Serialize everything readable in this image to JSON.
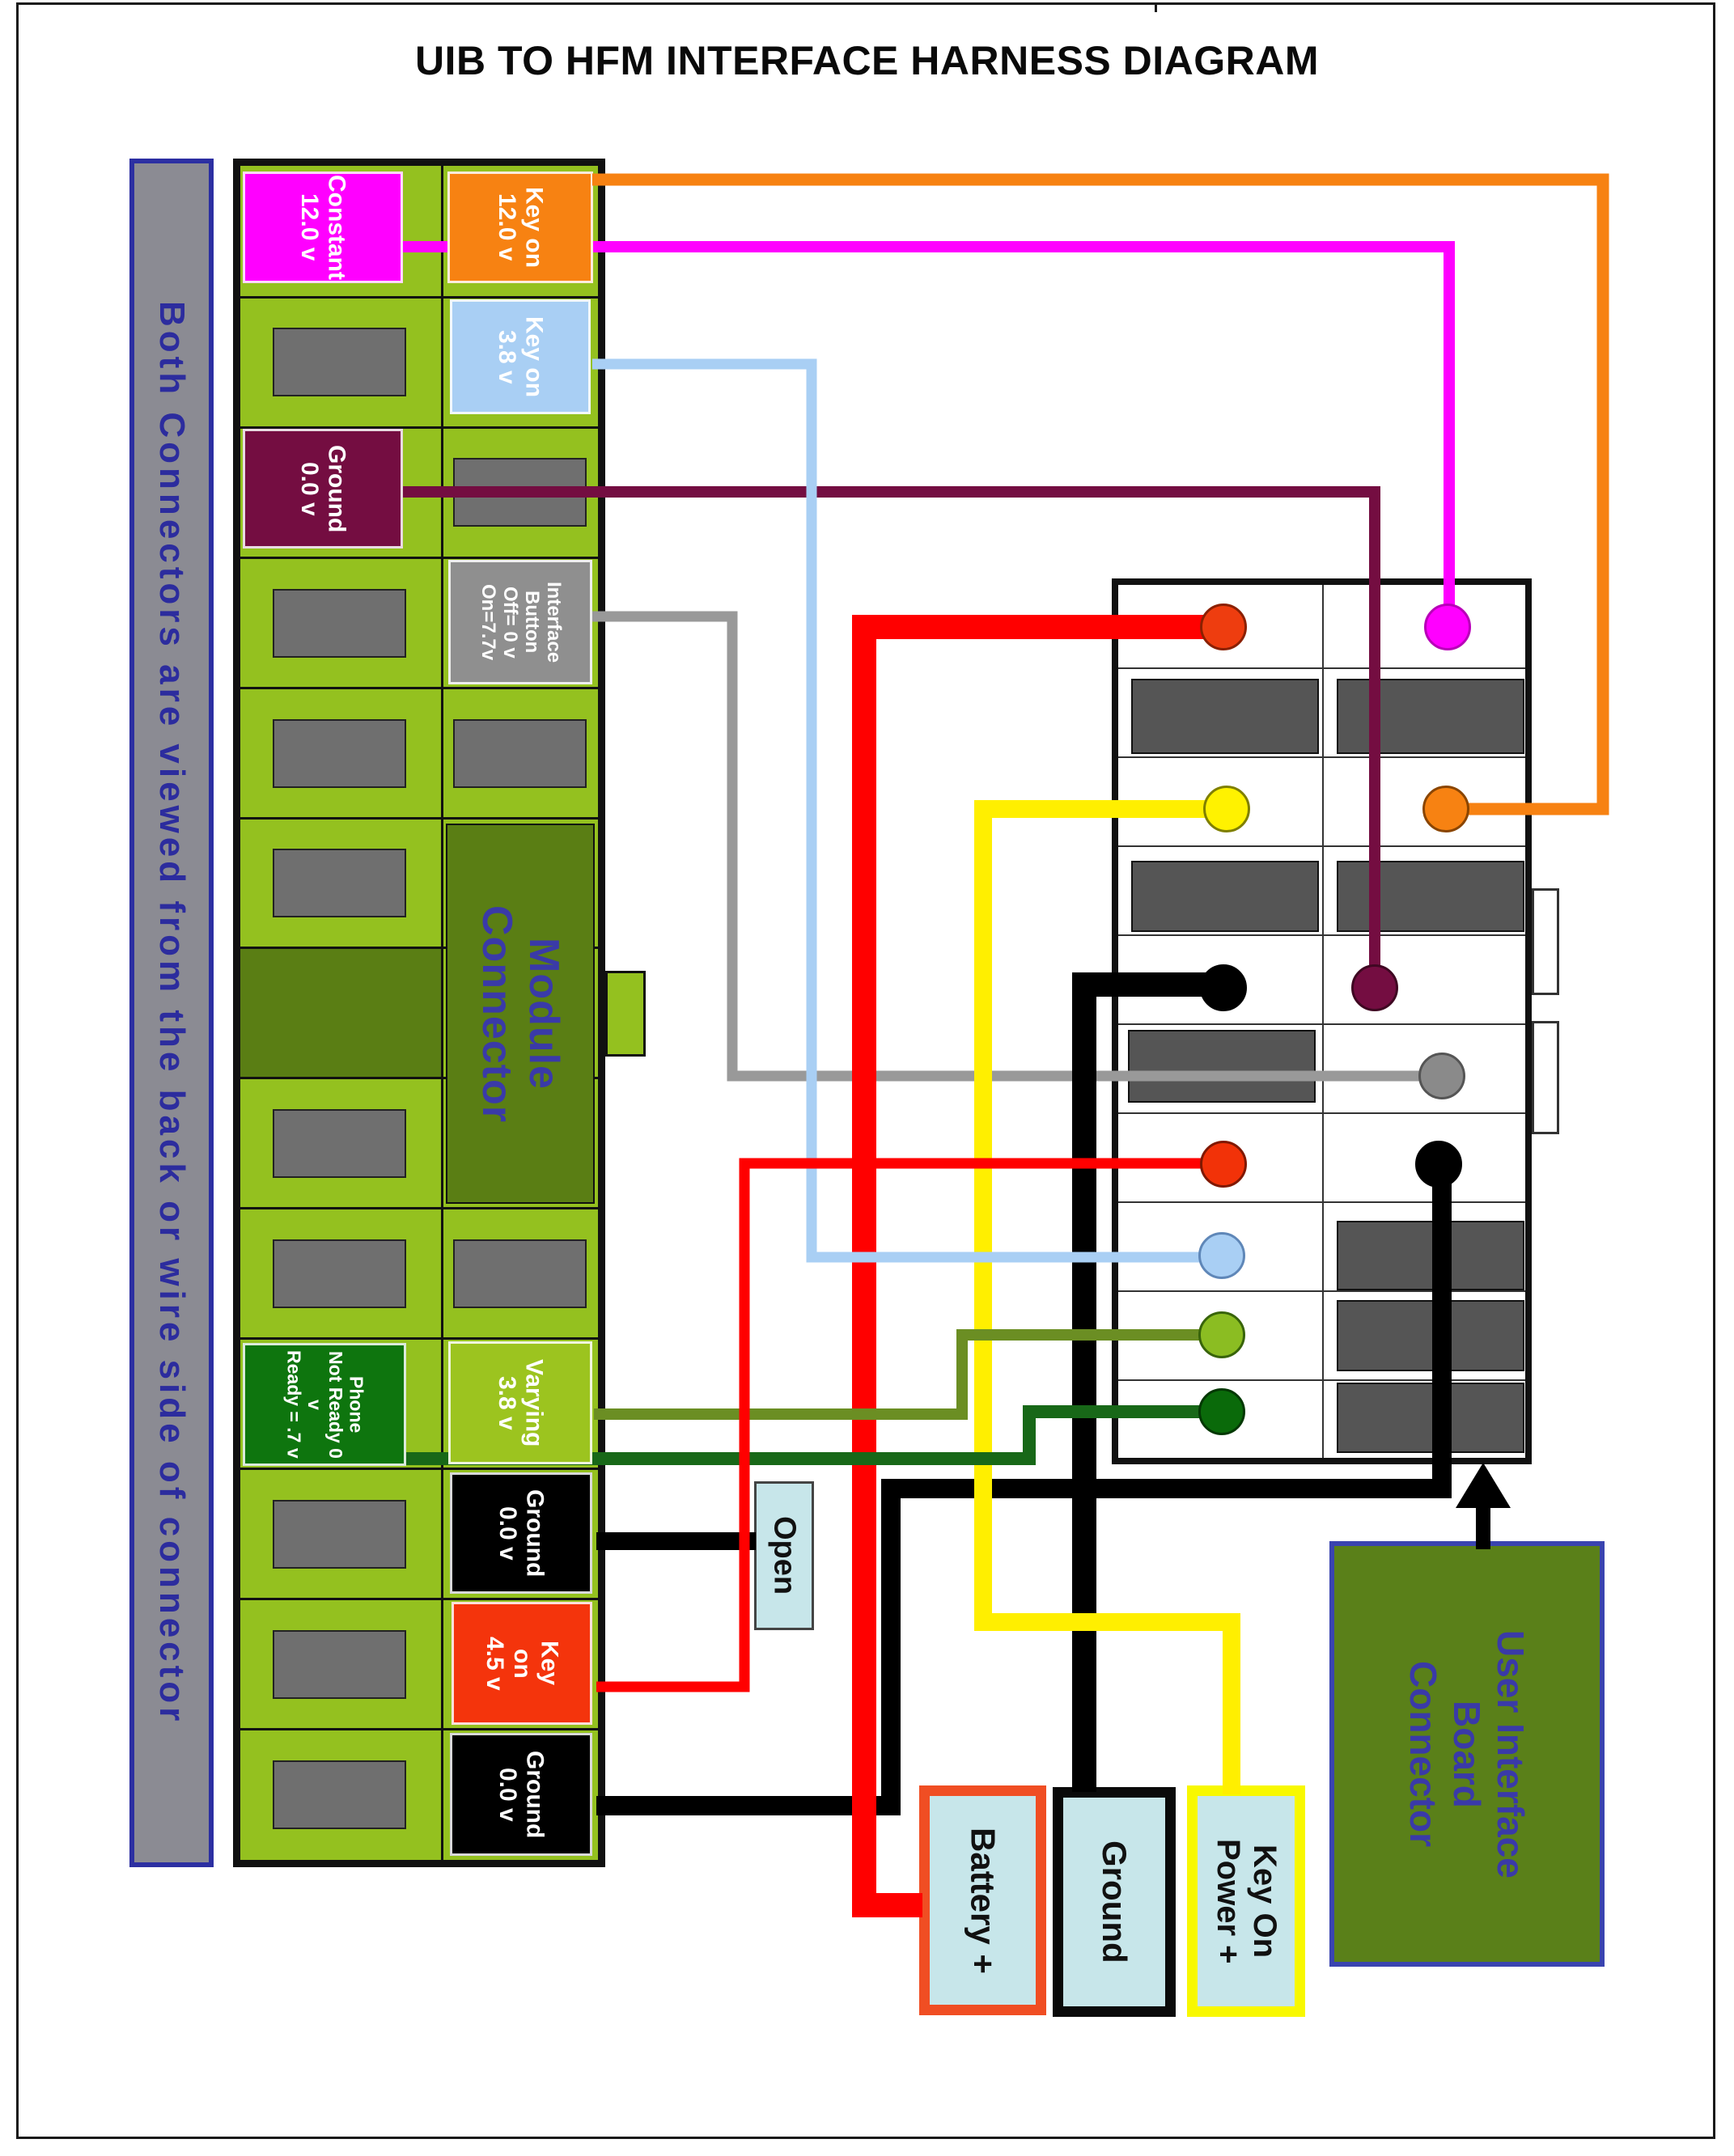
{
  "title": "UIB TO HFM INTERFACE HARNESS DIAGRAM",
  "side_note": "Both Connectors are viewed from the back or wire side of connector",
  "module_connector": {
    "name": "Module\nConnector",
    "labels": {
      "constant_12v": "Constant\n12.0 v",
      "key_on_12v": "Key on\n12.0 v",
      "key_on_3_8v": "Key on\n3.8 v",
      "ground_top": "Ground\n0.0 v",
      "interface_button": "Interface\nButton\nOff= 0 v\nOn=7.7v",
      "phone": "Phone\nNot Ready 0 v\nReady = .7 v",
      "varying_3_8v": "Varying\n3.8 v",
      "ground_mid": "Ground\n0.0 v",
      "key_on_4_5v": "Key\non\n4.5 v",
      "ground_bottom": "Ground\n0.0 v"
    }
  },
  "uib_connector": {
    "name": "User Interface\nBoard\nConnector",
    "pins": [
      {
        "row": 1,
        "left": "red-orange",
        "right": "magenta"
      },
      {
        "row": 2,
        "left": "blocked-slot",
        "right": "blocked-slot"
      },
      {
        "row": 3,
        "left": "yellow",
        "right": "orange"
      },
      {
        "row": 4,
        "left": "blocked-slot",
        "right": "blocked-slot"
      },
      {
        "row": 5,
        "left": "black",
        "right": "maroon"
      },
      {
        "row": 6,
        "left": "blocked-slot",
        "right": "gray"
      },
      {
        "row": 7,
        "left": "red",
        "right": "black"
      },
      {
        "row": 8,
        "left": "light-blue",
        "right": "blocked-slot"
      },
      {
        "row": 9,
        "left": "green",
        "right": "blocked-slot"
      },
      {
        "row": 10,
        "left": "dark-green",
        "right": "blocked-slot"
      }
    ]
  },
  "terminals": {
    "open": "Open",
    "battery": "Battery +",
    "ground": "Ground",
    "key_on_power": "Key On\nPower +"
  },
  "colors": {
    "board_green": "#94C11F",
    "dark_olive": "#5A7E14",
    "magenta": "#FF00FF",
    "orange": "#F78212",
    "light_blue": "#A9CFF4",
    "maroon": "#740D41",
    "gray_wire": "#999999",
    "olive_wire": "#6B8E23",
    "dark_green": "#186818",
    "yellow": "#FFEF00",
    "red": "#FF0000",
    "black": "#000000",
    "terminal_blue": "#C7E6EA",
    "note_blue": "#2C2C9E"
  }
}
